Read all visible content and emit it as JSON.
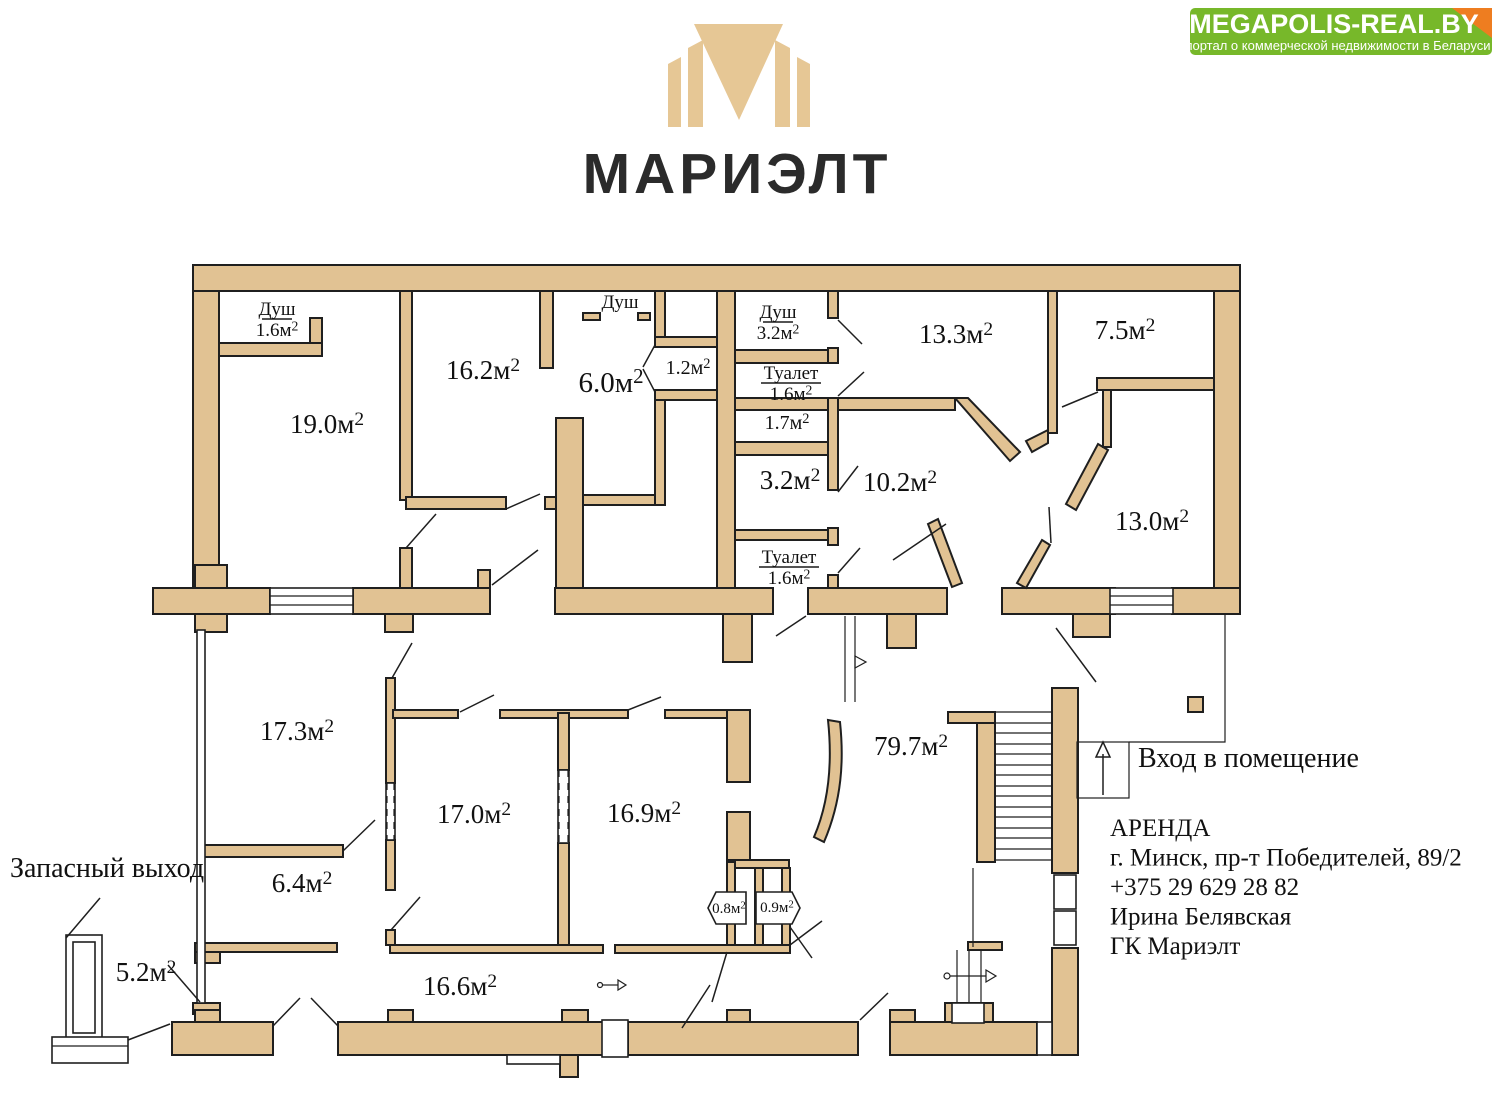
{
  "branding": {
    "logo_text": "МАРИЭЛТ",
    "banner_title": "MEGAPOLIS-REAL.BY",
    "banner_subtitle": "портал о коммерческой недвижимости в Беларуси"
  },
  "colors": {
    "wall": "#e1c293",
    "outline": "#1f1f1f",
    "banner_green": "#77b82a",
    "fold_orange": "#ee7d20",
    "logo_gold": "#e6c795",
    "text_dark": "#2b2b2b"
  },
  "plan": {
    "rooms": [
      {
        "id": "room-19-0",
        "label": "19.0м²",
        "x": 327,
        "y": 433,
        "fs": 27
      },
      {
        "id": "room-16-2",
        "label": "16.2м²",
        "x": 483,
        "y": 379,
        "fs": 27
      },
      {
        "id": "room-6-0",
        "label": "6.0м²",
        "x": 611,
        "y": 392,
        "fs": 29
      },
      {
        "id": "room-1-2",
        "label": "1.2м²",
        "x": 688,
        "y": 374,
        "fs": 20
      },
      {
        "id": "room-1-7",
        "label": "1.7м²",
        "x": 787,
        "y": 429,
        "fs": 20
      },
      {
        "id": "room-3-2",
        "label": "3.2м²",
        "x": 790,
        "y": 489,
        "fs": 27
      },
      {
        "id": "room-10-2",
        "label": "10.2м²",
        "x": 900,
        "y": 491,
        "fs": 27
      },
      {
        "id": "room-13-3",
        "label": "13.3м²",
        "x": 956,
        "y": 343,
        "fs": 27
      },
      {
        "id": "room-7-5",
        "label": "7.5м²",
        "x": 1125,
        "y": 339,
        "fs": 27
      },
      {
        "id": "room-13-0",
        "label": "13.0м²",
        "x": 1152,
        "y": 530,
        "fs": 27
      },
      {
        "id": "room-17-3",
        "label": "17.3м²",
        "x": 297,
        "y": 740,
        "fs": 27
      },
      {
        "id": "room-17-0",
        "label": "17.0м²",
        "x": 474,
        "y": 823,
        "fs": 27
      },
      {
        "id": "room-16-9",
        "label": "16.9м²",
        "x": 644,
        "y": 822,
        "fs": 27
      },
      {
        "id": "room-79-7",
        "label": "79.7м²",
        "x": 911,
        "y": 755,
        "fs": 27
      },
      {
        "id": "room-6-4",
        "label": "6.4м²",
        "x": 302,
        "y": 892,
        "fs": 27
      },
      {
        "id": "room-5-2",
        "label": "5.2м²",
        "x": 146,
        "y": 981,
        "fs": 27
      },
      {
        "id": "room-16-6",
        "label": "16.6м²",
        "x": 460,
        "y": 995,
        "fs": 27
      },
      {
        "id": "room-0-8",
        "label": "0.8м²",
        "x": 729,
        "y": 913,
        "fs": 15
      },
      {
        "id": "room-0-9",
        "label": "0.9м²",
        "x": 777,
        "y": 912,
        "fs": 15
      }
    ],
    "fixtures": [
      {
        "id": "shower-1",
        "name": "Душ",
        "area": "1.6м²",
        "x": 277,
        "y": 315,
        "underline": true
      },
      {
        "id": "shower-2",
        "name": "Душ",
        "x": 620,
        "y": 308
      },
      {
        "id": "shower-3",
        "name": "Душ",
        "area": "3.2м²",
        "x": 778,
        "y": 318,
        "underline": true
      },
      {
        "id": "wc-1",
        "name": "Туалет",
        "area": "1.6м²",
        "x": 791,
        "y": 379,
        "underline": true
      },
      {
        "id": "wc-2",
        "name": "Туалет",
        "area": "1.6м²",
        "x": 789,
        "y": 563,
        "underline": true
      }
    ],
    "annotations": [
      {
        "id": "emergency-exit-label",
        "text": "Запасный выход",
        "x": 10,
        "y": 877,
        "fs": 28
      },
      {
        "id": "entrance-label",
        "text": "Вход в помещение",
        "x": 1138,
        "y": 767,
        "fs": 28
      }
    ],
    "contact": {
      "x": 1110,
      "y0": 836,
      "lh": 29.5,
      "fs": 25,
      "lines": [
        "АРЕНДА",
        "г. Минск, пр-т Победителей, 89/2",
        "+375 29 629 28 82",
        "Ирина Белявская",
        "ГК Мариэлт"
      ]
    }
  }
}
